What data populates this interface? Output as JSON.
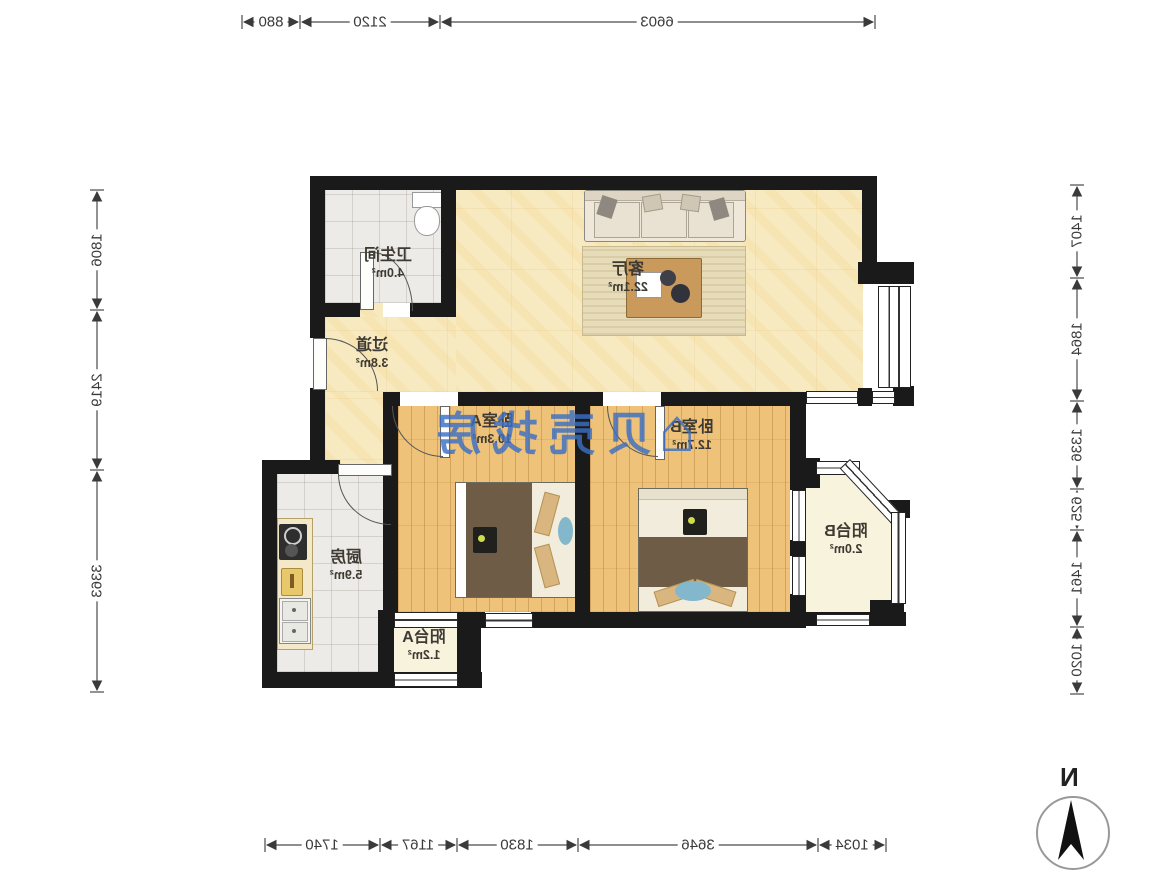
{
  "orientation_note": "entire plan rendered mirrored horizontally as in screenshot",
  "rooms": [
    {
      "id": "living",
      "name": "客厅",
      "area": "22.1m²"
    },
    {
      "id": "bathroom",
      "name": "卫生间",
      "area": "4.0m²"
    },
    {
      "id": "hallway",
      "name": "过道",
      "area": "3.8m²"
    },
    {
      "id": "bedroomA",
      "name": "卧室A",
      "area": "10.3m²"
    },
    {
      "id": "bedroomB",
      "name": "卧室B",
      "area": "12.7m²"
    },
    {
      "id": "balconyB",
      "name": "阳台B",
      "area": "2.0m²"
    },
    {
      "id": "kitchen",
      "name": "厨房",
      "area": "5.9m²"
    },
    {
      "id": "balconyA",
      "name": "阳台A",
      "area": "1.2m²"
    }
  ],
  "dimensions": {
    "top": [
      "880",
      "2120",
      "6603"
    ],
    "left": [
      "1806",
      "2419",
      "3363"
    ],
    "right": [
      "1407",
      "1864",
      "1336",
      "625",
      "1461",
      "1020"
    ],
    "bottom": [
      "1740",
      "1167",
      "1830",
      "3646",
      "1034"
    ]
  },
  "watermark": {
    "text": "贝壳找房",
    "icon": "house-icon",
    "color": "#3a6fc5"
  },
  "compass": {
    "label": "N"
  },
  "colors": {
    "wall": "#1a1a1a",
    "floor_wood": "#eec279",
    "floor_beige": "#f7e9c0",
    "floor_tile": "#edebe7",
    "floor_balcony": "#f8f3dd",
    "dimension_text": "#3a3a3a"
  }
}
